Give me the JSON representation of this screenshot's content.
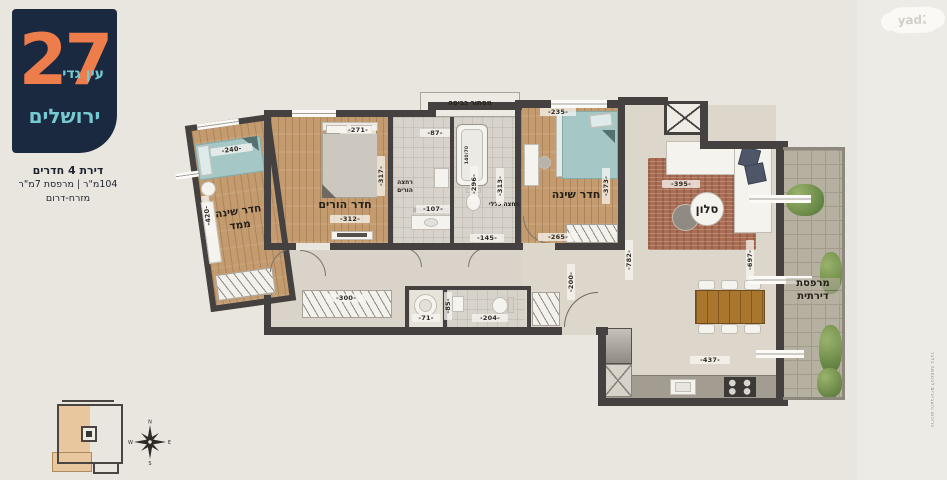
{
  "branding": {
    "number": "27",
    "project": "עין גדי",
    "city": "ירושלים"
  },
  "listing": {
    "title": "דירת 4 חדרים",
    "area": "104מ\"ר | מרפסת 7מ\"ר",
    "orientation": "מזרח-דרום"
  },
  "watermark": {
    "label": "yad2"
  },
  "rooms": {
    "safe_room_line1": "חדר שינה",
    "safe_room_line2": "ממד",
    "parents": "חדר הורים",
    "bath_parents_line1": "רחצה",
    "bath_parents_line2": "הורים",
    "bath_general": "רחצה כללי",
    "bedroom": "חדר שינה",
    "living": "סלון",
    "balcony_line1": "מרפסת",
    "balcony_line2": "דירתית",
    "laundry_niche": "מסתור כביסה",
    "tub_size": "140/70"
  },
  "dims": {
    "d240": "-240-",
    "d420": "-420-",
    "d271": "-271-",
    "d312": "-312-",
    "d317": "-317-",
    "d87": "-87-",
    "d296": "-296-",
    "d107": "-107-",
    "d145": "-145-",
    "d313": "-313-",
    "d235": "-235-",
    "d373": "-373-",
    "d265": "-265-",
    "d395": "-395-",
    "d200": "-200-",
    "d782": "-782-",
    "d697": "-697-",
    "d300": "-300-",
    "d71": "-71-",
    "d85": "-85-",
    "d204": "-204-",
    "d437": "-437-"
  },
  "compass": {
    "n": "N",
    "e": "E",
    "s": "S",
    "w": "W"
  },
  "disclaimer": "הריהוט והאביזרים להמחשה בלבד"
}
